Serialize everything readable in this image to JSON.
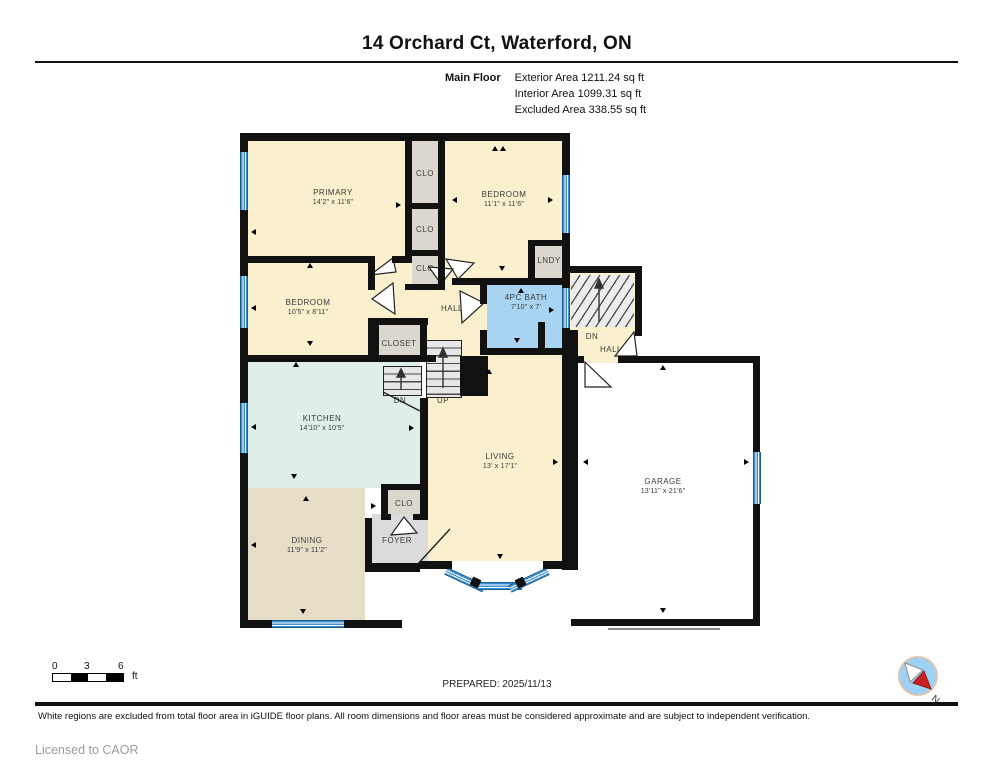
{
  "header": {
    "title": "14 Orchard Ct, Waterford, ON",
    "floor_label": "Main Floor",
    "area_lines": [
      "Exterior Area 1211.24 sq ft",
      "Interior Area 1099.31 sq ft",
      "Excluded Area 338.55 sq ft"
    ]
  },
  "rooms": {
    "primary": {
      "name": "PRIMARY",
      "dims": "14'2\" x 11'6\""
    },
    "bedroom_tr": {
      "name": "BEDROOM",
      "dims": "11'1\" x 11'6\""
    },
    "bedroom_ml": {
      "name": "BEDROOM",
      "dims": "10'5\" x 8'11\""
    },
    "bath": {
      "name": "4PC BATH",
      "dims": "7'10\" x 7'"
    },
    "kitchen": {
      "name": "KITCHEN",
      "dims": "14'10\" x 10'5\""
    },
    "dining": {
      "name": "DINING",
      "dims": "11'9\" x 11'2\""
    },
    "living": {
      "name": "LIVING",
      "dims": "13' x 17'1\""
    },
    "garage": {
      "name": "GARAGE",
      "dims": "13'11\" x 21'6\""
    },
    "hall": {
      "name": "HALL"
    },
    "closet": {
      "name": "CLOSET"
    },
    "clo_top": {
      "name": "CLO"
    },
    "clo_mid": {
      "name": "CLO"
    },
    "clo_low": {
      "name": "CLO"
    },
    "clo_foyer": {
      "name": "CLO"
    },
    "lndy": {
      "name": "LNDY"
    },
    "foyer": {
      "name": "FOYER"
    },
    "entry_dn": {
      "name": "DN"
    },
    "entry_hall": {
      "name": "HALL"
    },
    "stairs_up": {
      "name": "UP"
    },
    "stairs_dn": {
      "name": "DN"
    }
  },
  "footer": {
    "scale": {
      "ticks": [
        "0",
        "3",
        "6"
      ],
      "unit": "ft"
    },
    "prepared": "PREPARED: 2025/11/13",
    "compass_north": "N",
    "disclaimer": "White regions are excluded from total floor area in iGUIDE floor plans. All room dimensions and floor areas must be considered approximate and are subject to independent verification.",
    "license": "Licensed to CAOR"
  },
  "colors": {
    "wall": "#111111",
    "floor_cream": "#FAF0CD",
    "kitchen_mint": "#DFEEE6",
    "dining_tan": "#E6DDC7",
    "closet_grey": "#DBD6CE",
    "foyer_grey": "#DBDBDB",
    "bath_blue": "#A9D4F1",
    "window_blue": "#3E8FD0",
    "garage_white": "#FFFFFF"
  }
}
